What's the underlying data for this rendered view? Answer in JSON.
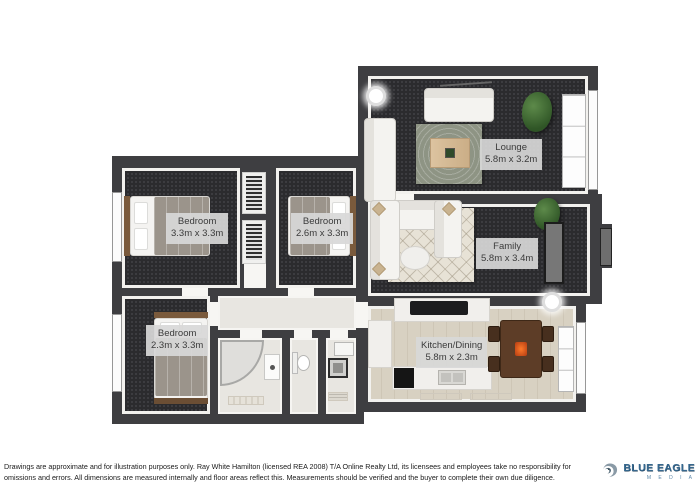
{
  "floorplan": {
    "rooms": [
      {
        "name": "Lounge",
        "dims": "5.8m x 3.2m"
      },
      {
        "name": "Family",
        "dims": "5.8m x 3.4m"
      },
      {
        "name": "Bedroom",
        "dims": "3.3m x 3.3m"
      },
      {
        "name": "Bedroom",
        "dims": "2.6m x 3.3m"
      },
      {
        "name": "Bedroom",
        "dims": "2.3m x 3.3m"
      },
      {
        "name": "Kitchen/Dining",
        "dims": "5.8m x 2.3m"
      }
    ],
    "colors": {
      "wall": "#3e3e41",
      "carpet": "#2b2b2e",
      "wood_floor": "#d8d1c2",
      "tile_floor": "#e8e6e1",
      "label_bg": "#d8d8d8",
      "label_text": "#3b3b3b",
      "logo_blue": "#36688f"
    }
  },
  "footer": {
    "disclaimer_line1": "Drawings are approximate and for illustration purposes only.  Ray White Hamilton (licensed REA 2008) T/A Online Realty Ltd, its licensees and employees take no responsibility for",
    "disclaimer_line2": "omissions and errors.  All dimensions are measured internally and floor areas reflect this. Measurements should be verified and the buyer to complete their own due diligence.",
    "logo": {
      "title": "BLUE EAGLE",
      "subtitle": "M E D I A"
    }
  }
}
